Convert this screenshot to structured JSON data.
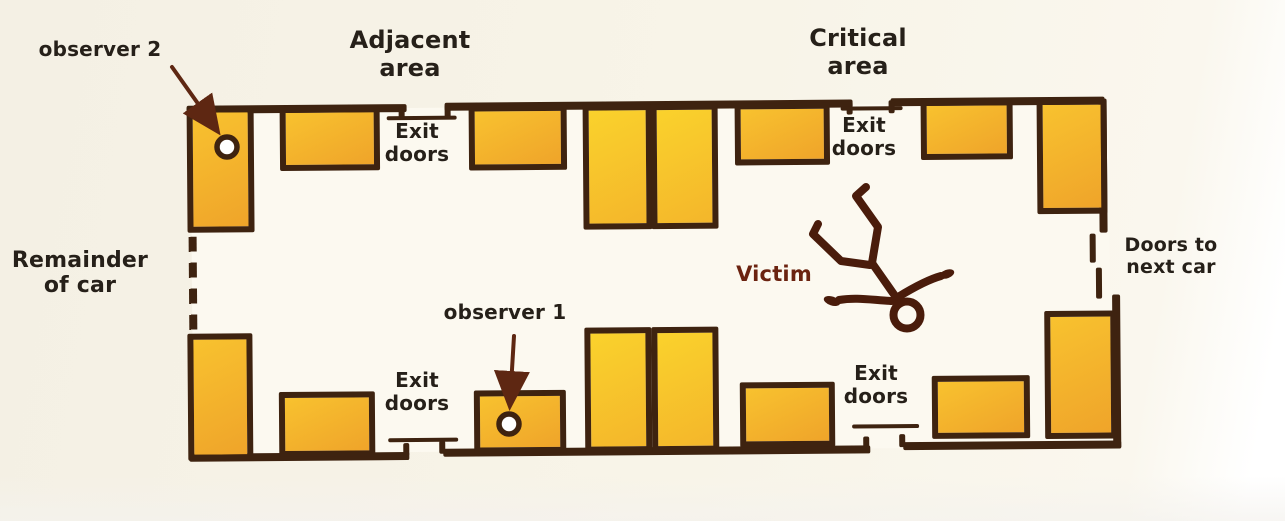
{
  "diagram": {
    "area_labels": {
      "adjacent": "Adjacent\narea",
      "critical": "Critical\narea"
    },
    "side_labels": {
      "remainder_of_car": "Remainder\nof car",
      "doors_to_next_car": "Doors to\nnext car"
    },
    "exit_door_labels": {
      "top_left": "Exit\ndoors",
      "top_right": "Exit\ndoors",
      "bottom_left": "Exit\ndoors",
      "bottom_right": "Exit\ndoors"
    },
    "markers": {
      "observer_1": "observer 1",
      "observer_2": "observer 2",
      "victim": "Victim"
    },
    "icons": {
      "victim_figure": "fallen-person-stick-figure-icon",
      "observer_marker": "circle-position-marker",
      "arrow": "pointer-arrow"
    },
    "colors": {
      "background": "#F8F4E8",
      "floor": "#FCF9F0",
      "outline": "#3E2310",
      "seat_fill_start": "#F8C22F",
      "seat_fill_end": "#EFA42A",
      "seat_bright_start": "#FAD22C",
      "seat_bright_end": "#F4B62B",
      "arrow": "#5E2712",
      "victim_figure": "#4A1C0B",
      "victim_text": "#6B2310",
      "text": "#262019"
    }
  }
}
